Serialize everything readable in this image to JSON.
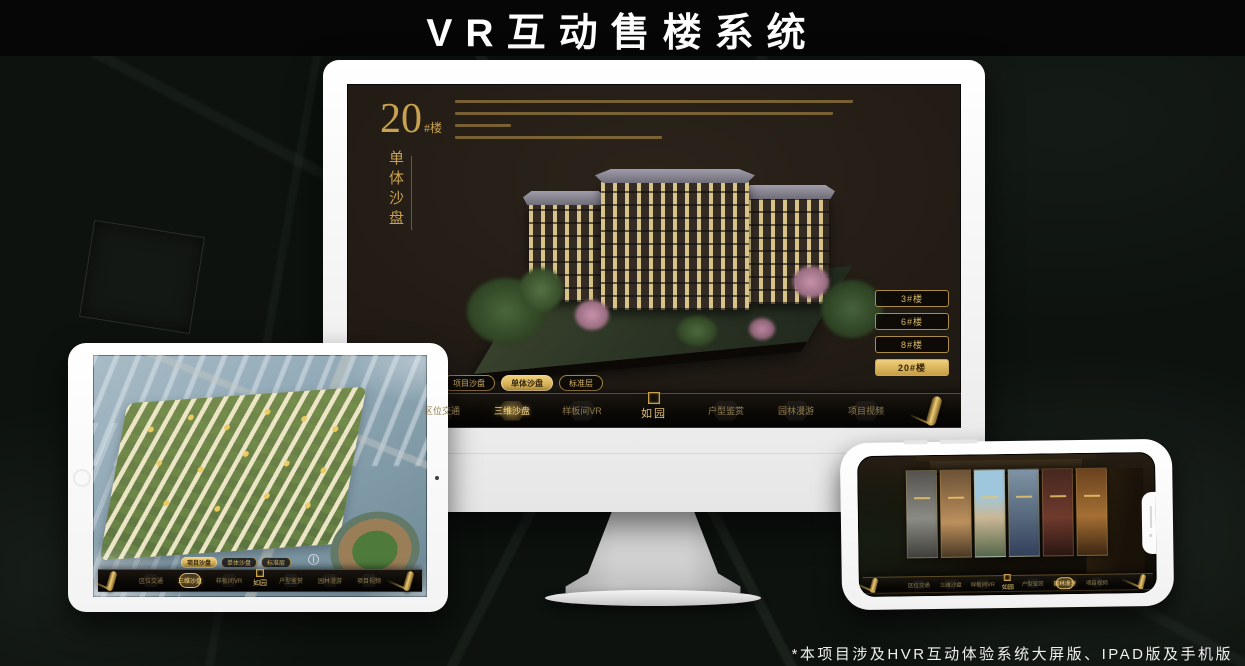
{
  "header": {
    "title": "VR互动售楼系统"
  },
  "footer": {
    "note": "*本项目涉及HVR互动体验系统大屏版、IPAD版及手机版"
  },
  "colors": {
    "gold": "#c9a24f",
    "gold_bright": "#e9c469",
    "screen_bg": "#221c15",
    "page_bg": "#0d120e"
  },
  "monitor_ui": {
    "title_number": "20",
    "title_unit": "#楼",
    "subtitle": "单体沙盘",
    "floor_buttons": [
      {
        "label": "3#楼",
        "active": false
      },
      {
        "label": "6#楼",
        "active": false
      },
      {
        "label": "8#楼",
        "active": false
      },
      {
        "label": "20#楼",
        "active": true
      }
    ],
    "view_tabs": [
      {
        "label": "项目沙盘",
        "active": false
      },
      {
        "label": "单体沙盘",
        "active": true
      },
      {
        "label": "标准层",
        "active": false
      }
    ],
    "nav_items": [
      {
        "label": "区位交通",
        "active": false
      },
      {
        "label": "三维沙盘",
        "active": true
      },
      {
        "label": "样板间VR",
        "active": false
      },
      {
        "label": "户型鉴赏",
        "active": false
      },
      {
        "label": "园林漫游",
        "active": false
      },
      {
        "label": "项目视频",
        "active": false
      }
    ],
    "logo": "如园"
  },
  "tablet_ui": {
    "view_tabs": [
      {
        "label": "项目沙盘",
        "active": true
      },
      {
        "label": "单体沙盘",
        "active": false
      },
      {
        "label": "标准层",
        "active": false
      }
    ],
    "nav_items": [
      {
        "label": "区位交通",
        "active": false
      },
      {
        "label": "三维沙盘",
        "active": true
      },
      {
        "label": "样板间VR",
        "active": false
      },
      {
        "label": "户型鉴赏",
        "active": false
      },
      {
        "label": "园林漫游",
        "active": false
      },
      {
        "label": "项目视频",
        "active": false
      }
    ],
    "logo": "如园"
  },
  "phone_ui": {
    "nav_items": [
      {
        "label": "区位交通",
        "active": false
      },
      {
        "label": "三维沙盘",
        "active": false
      },
      {
        "label": "样板间VR",
        "active": false
      },
      {
        "label": "户型鉴赏",
        "active": false
      },
      {
        "label": "园林漫游",
        "active": true
      },
      {
        "label": "项目视频",
        "active": false
      }
    ],
    "logo": "如园"
  }
}
